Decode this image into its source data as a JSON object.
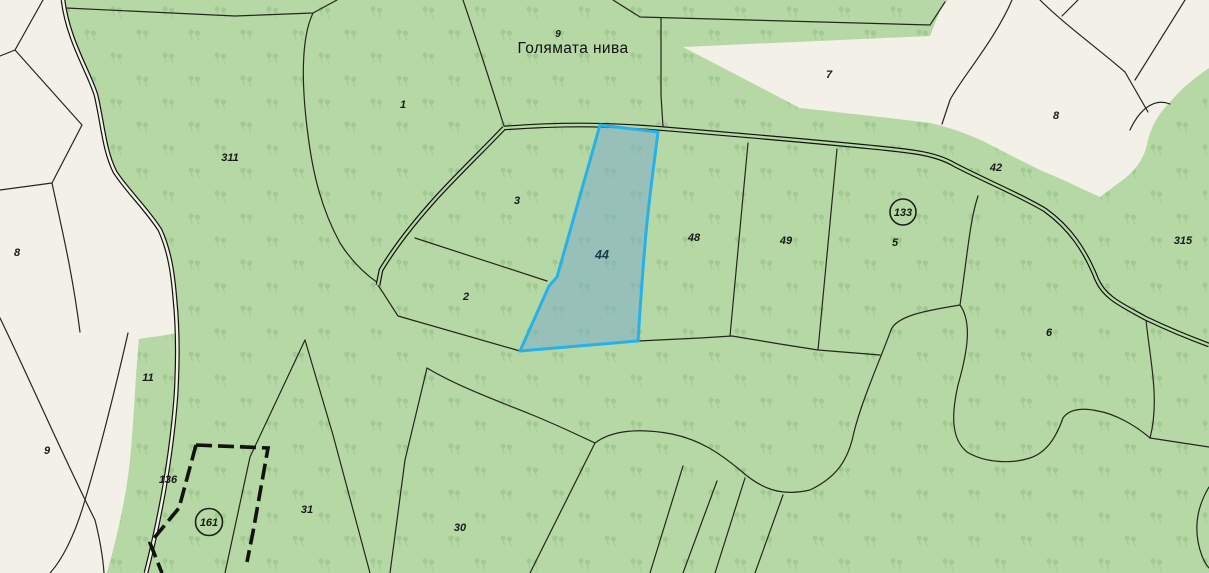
{
  "map": {
    "region": {
      "name": "Голямата нива",
      "number": "9",
      "name_x": 573,
      "name_y": 53,
      "num_x": 558,
      "num_y": 37
    },
    "highlight": {
      "fill": "#78aac9",
      "border": "#27b1e9",
      "selected_parcel": "44"
    },
    "colors": {
      "forest_green": "#b6d8a5",
      "tree_symbol": "#9dc88f",
      "open_land": "#f2f0e7",
      "boundary_line": "#26261e",
      "road_line": "#12120f",
      "label_text": "#1a1a1a"
    },
    "parcels": [
      {
        "label": "311",
        "x": 230,
        "y": 161,
        "circled": false
      },
      {
        "label": "1",
        "x": 403,
        "y": 108,
        "circled": false
      },
      {
        "label": "7",
        "x": 829,
        "y": 78,
        "circled": false
      },
      {
        "label": "8",
        "x": 1056,
        "y": 119,
        "circled": false
      },
      {
        "label": "42",
        "x": 996,
        "y": 171,
        "circled": false
      },
      {
        "label": "133",
        "x": 903,
        "y": 216,
        "circled": true
      },
      {
        "label": "5",
        "x": 895,
        "y": 246,
        "circled": false
      },
      {
        "label": "315",
        "x": 1183,
        "y": 244,
        "circled": false
      },
      {
        "label": "3",
        "x": 517,
        "y": 204,
        "circled": false
      },
      {
        "label": "44",
        "x": 602,
        "y": 259,
        "circled": false
      },
      {
        "label": "48",
        "x": 694,
        "y": 241,
        "circled": false
      },
      {
        "label": "49",
        "x": 786,
        "y": 244,
        "circled": false
      },
      {
        "label": "2",
        "x": 466,
        "y": 300,
        "circled": false
      },
      {
        "label": "6",
        "x": 1049,
        "y": 336,
        "circled": false
      },
      {
        "label": "8",
        "x": 17,
        "y": 256,
        "circled": false
      },
      {
        "label": "11",
        "x": 148,
        "y": 381,
        "circled": false
      },
      {
        "label": "9",
        "x": 47,
        "y": 454,
        "circled": false
      },
      {
        "label": "136",
        "x": 168,
        "y": 483,
        "circled": false
      },
      {
        "label": "161",
        "x": 209,
        "y": 526,
        "circled": true
      },
      {
        "label": "31",
        "x": 307,
        "y": 513,
        "circled": false
      },
      {
        "label": "30",
        "x": 460,
        "y": 531,
        "circled": false
      }
    ]
  }
}
